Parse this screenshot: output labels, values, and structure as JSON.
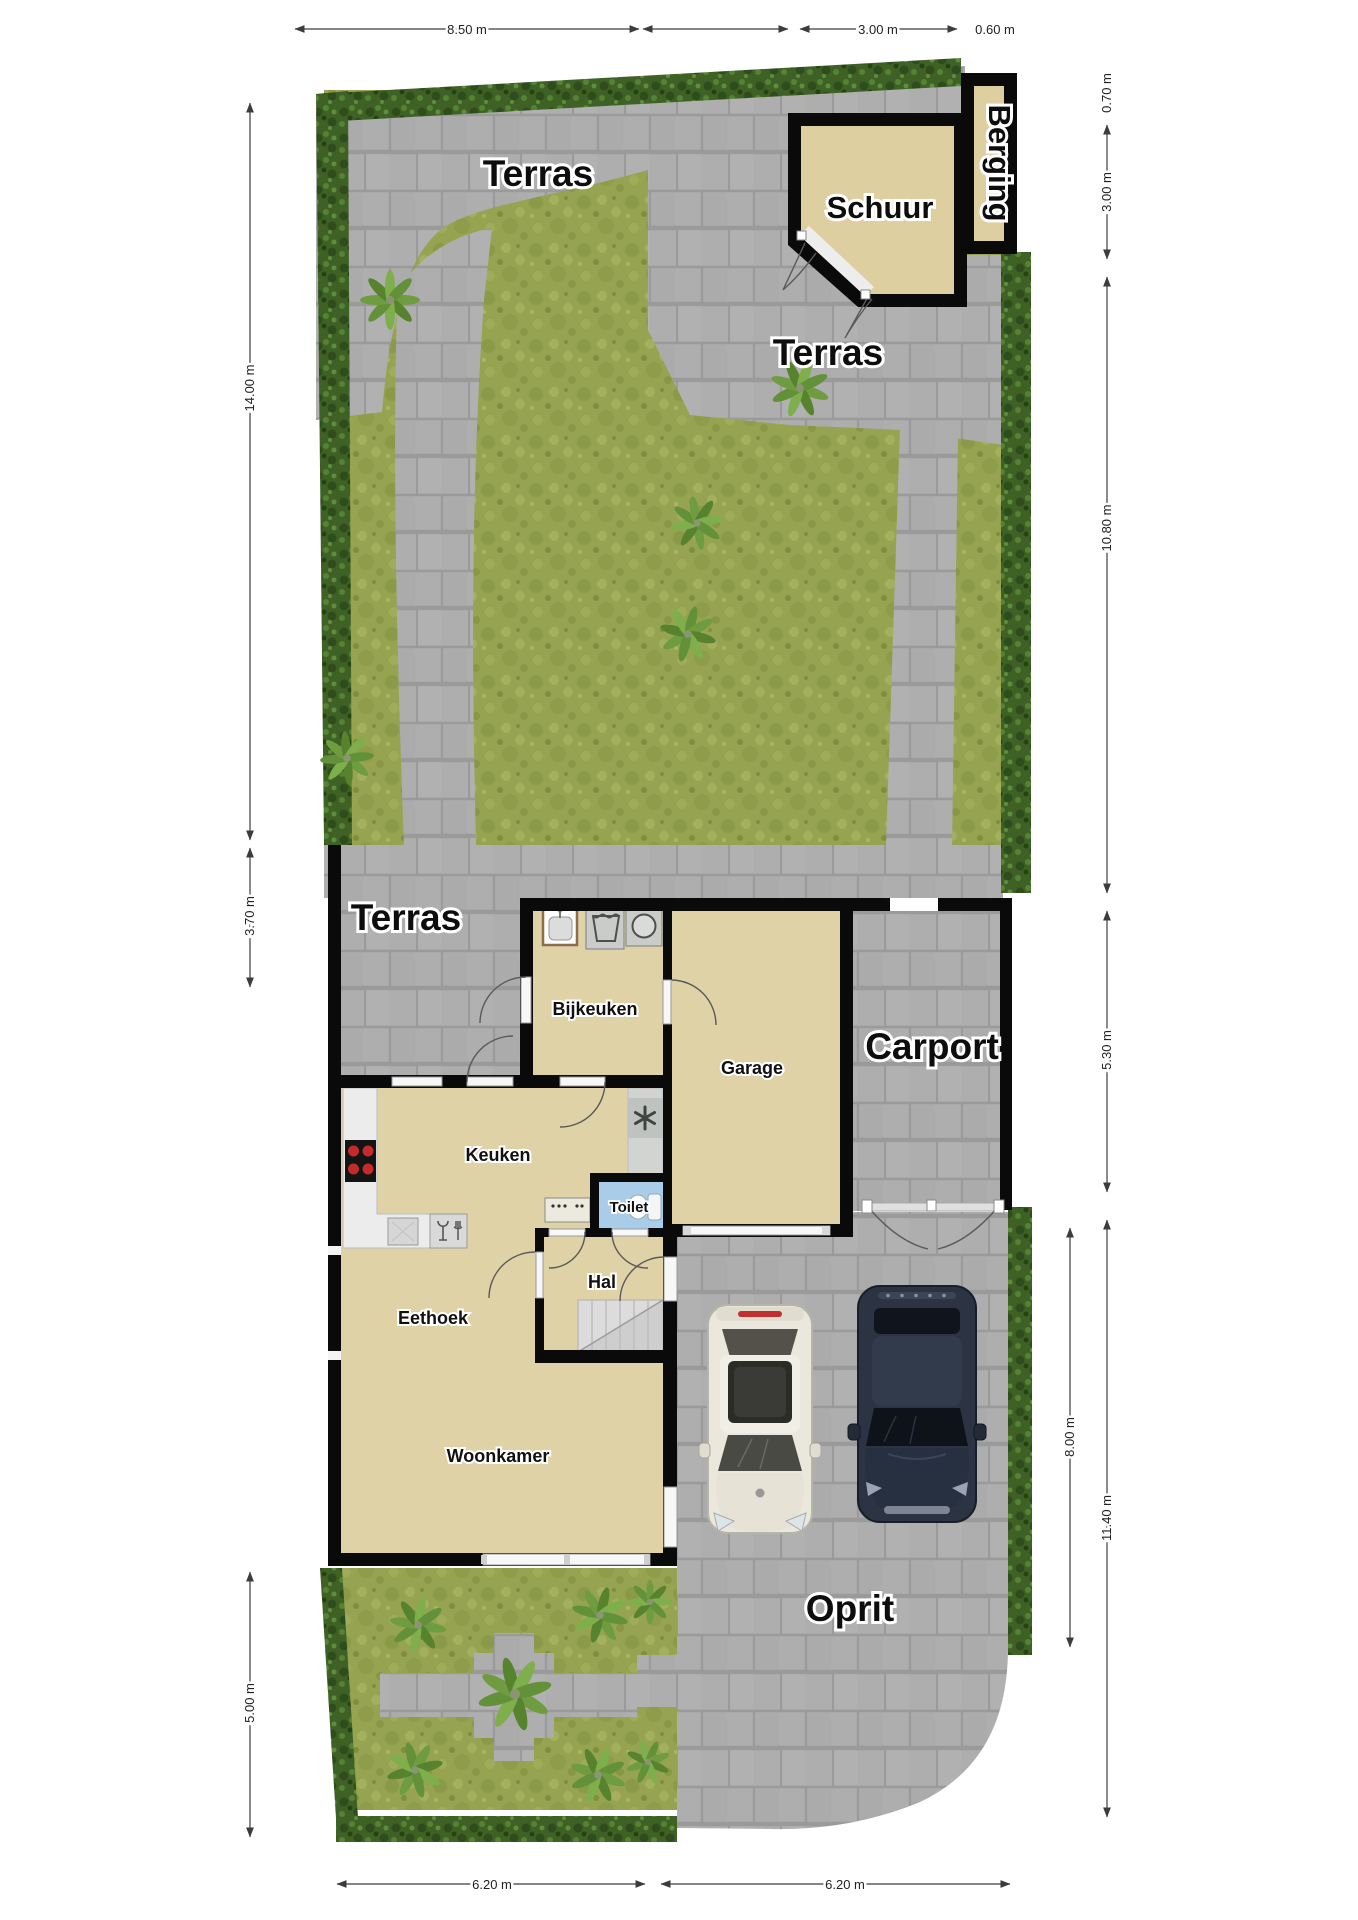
{
  "document": {
    "kind": "site-floor-plan",
    "language": "nl"
  },
  "areas": {
    "terras_top": "Terras",
    "schuur": "Schuur",
    "berging": "Berging",
    "terras_mid": "Terras",
    "terras_lower": "Terras",
    "carport": "Carport",
    "oprit": "Oprit"
  },
  "rooms": {
    "bijkeuken": "Bijkeuken",
    "garage": "Garage",
    "keuken": "Keuken",
    "toilet": "Toilet",
    "hal": "Hal",
    "eethoek": "Eethoek",
    "woonkamer": "Woonkamer"
  },
  "dimensions": {
    "top": [
      {
        "label": "8.50 m"
      },
      {
        "label": "3.00 m"
      },
      {
        "label": "0.60 m"
      }
    ],
    "right": [
      {
        "label": "0.70 m"
      },
      {
        "label": "3.00 m"
      },
      {
        "label": "10.80 m"
      },
      {
        "label": "5.30 m"
      },
      {
        "label": "11.40 m"
      },
      {
        "label": "8.00 m"
      }
    ],
    "left": [
      {
        "label": "14.00 m"
      },
      {
        "label": "3.70 m"
      },
      {
        "label": "5.00 m"
      }
    ],
    "bottom": [
      {
        "label": "6.20 m"
      },
      {
        "label": "6.20 m"
      }
    ]
  },
  "colors": {
    "room_fill": "#ded2a6",
    "schuur_fill": "#ddcf9f",
    "paving": "#adadad",
    "grass": "#96a452",
    "hedge": "#3f6126",
    "toilet_floor": "#a9cde9",
    "wall": "#0a0a0a"
  }
}
